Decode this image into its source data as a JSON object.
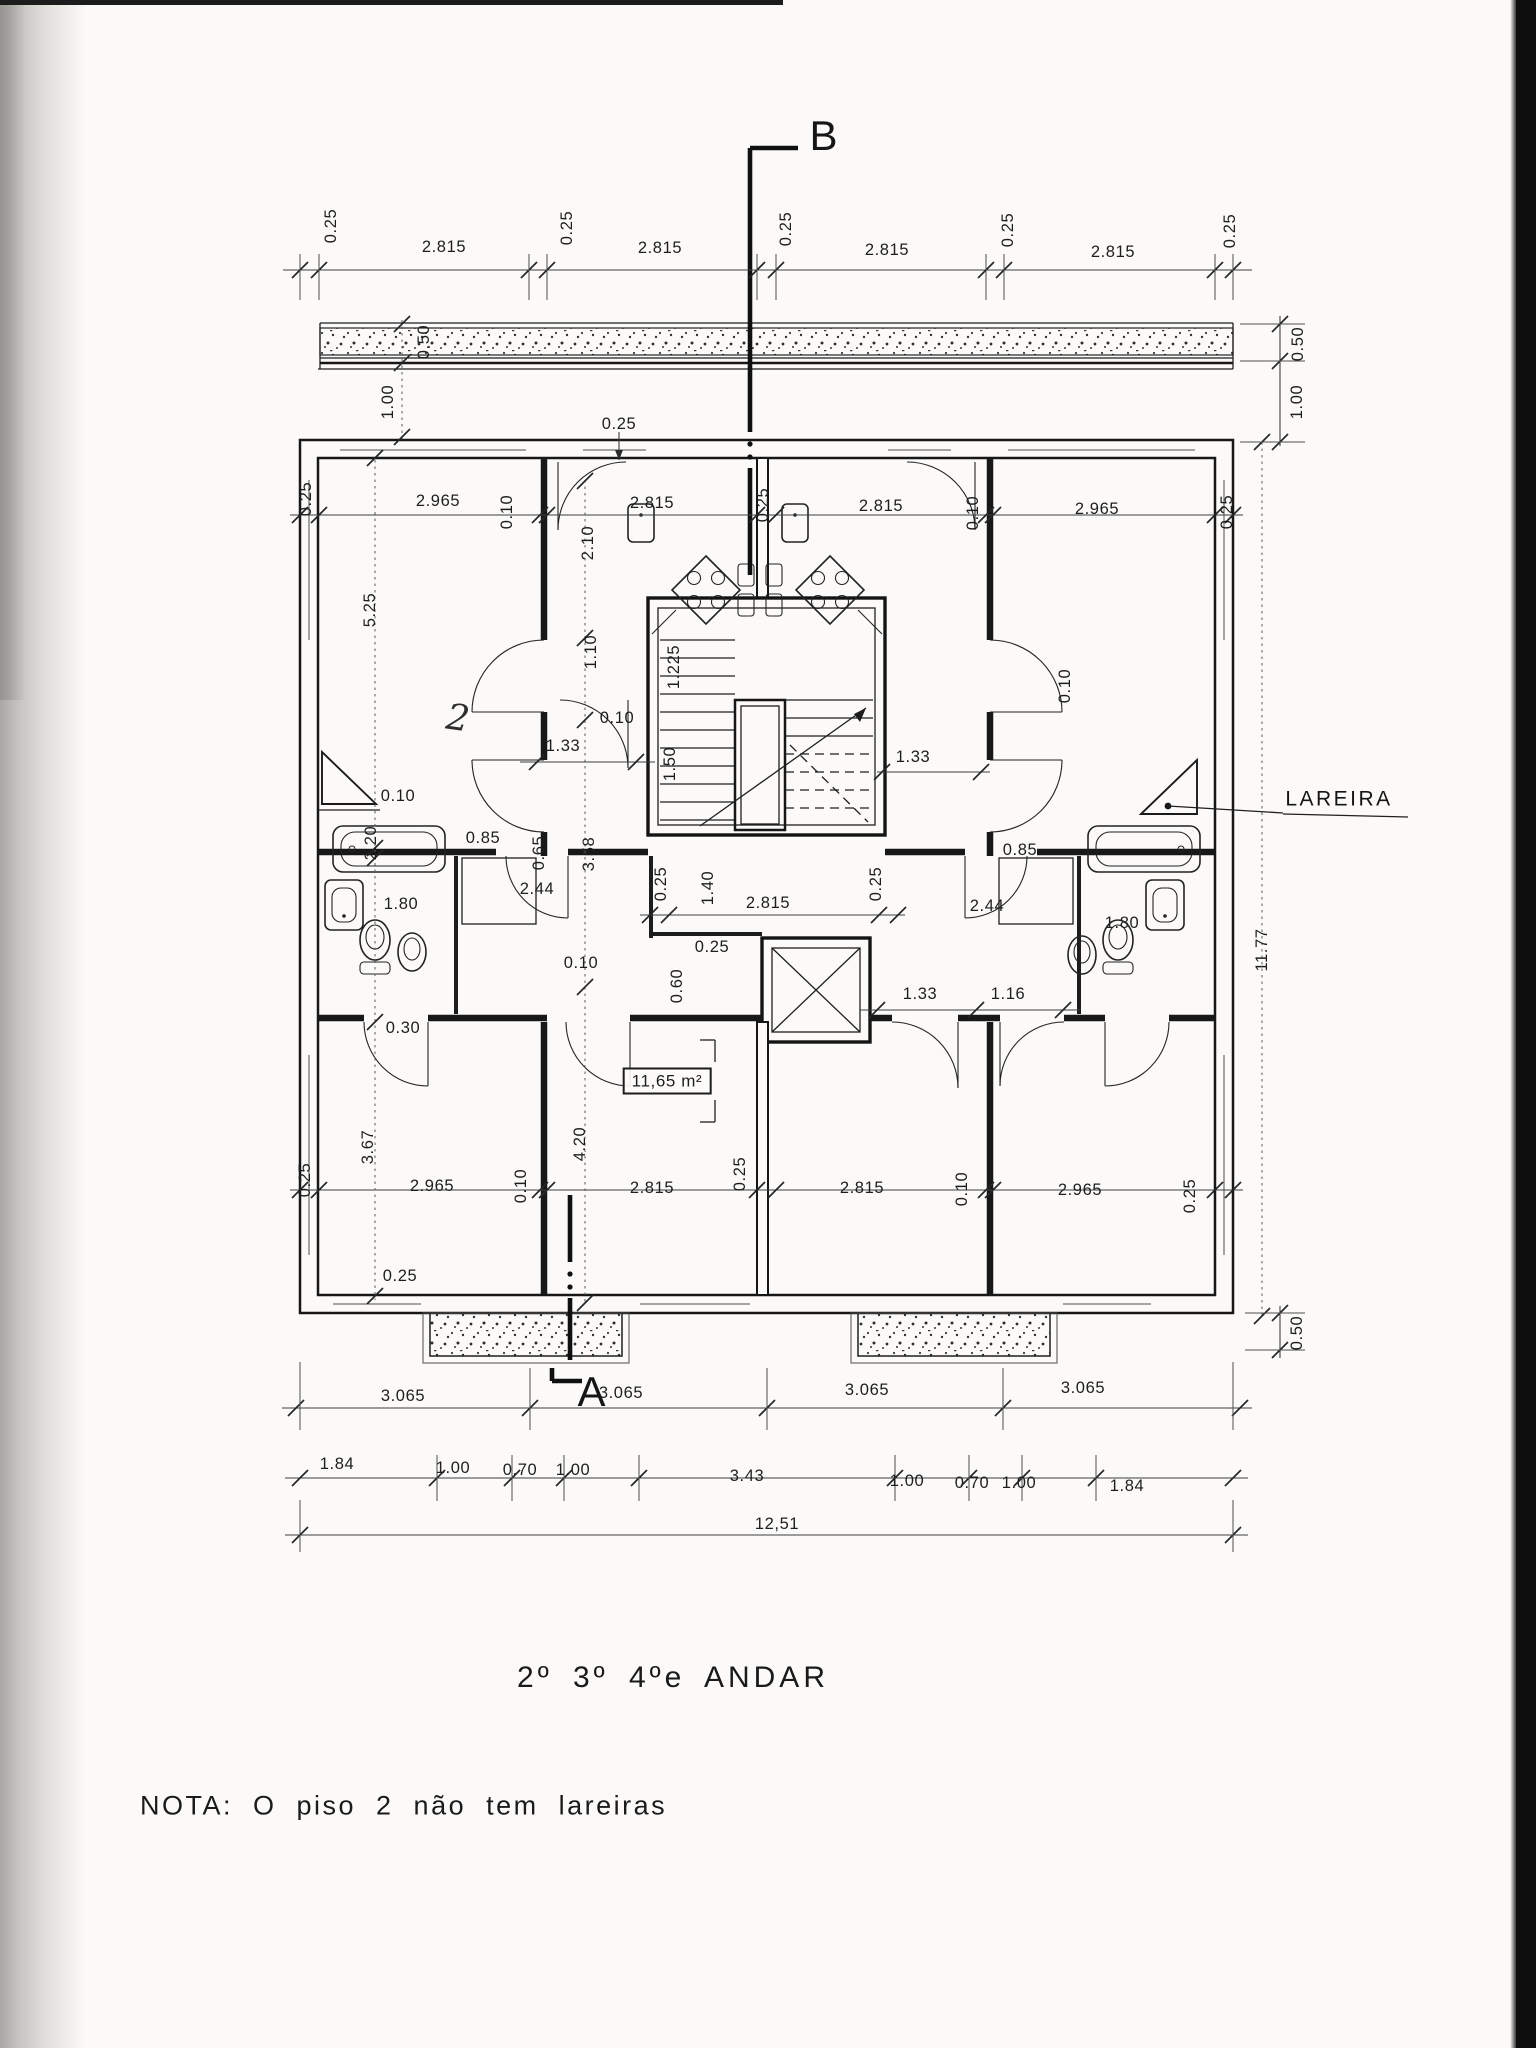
{
  "document": {
    "type_label": "architectural-floor-plan-scan",
    "title": "2º 3º 4ºe ANDAR",
    "note": "NOTA: O  piso 2  não  tem  lareiras",
    "section_marker_top": "B",
    "section_marker_bottom": "A",
    "fireplace_label": "LAREIRA",
    "area_label": "11,65 m²",
    "handwritten_mark": "2",
    "ink_color": "#1a1a1a",
    "paper_color": "#fbfaf8",
    "scan_bar_color": "#0e0e0e"
  },
  "labels": [
    {
      "t": "B",
      "x": 824,
      "y": 136,
      "r": 0,
      "c": "sec",
      "n": "section-marker-b"
    },
    {
      "t": "A",
      "x": 592,
      "y": 1392,
      "r": 0,
      "c": "sec",
      "n": "section-marker-a"
    },
    {
      "t": "0.25",
      "x": 331,
      "y": 226,
      "r": -90
    },
    {
      "t": "2.815",
      "x": 444,
      "y": 247,
      "r": 0
    },
    {
      "t": "0.25",
      "x": 567,
      "y": 228,
      "r": -90
    },
    {
      "t": "2.815",
      "x": 660,
      "y": 248,
      "r": 0
    },
    {
      "t": "0.25",
      "x": 786,
      "y": 229,
      "r": -90
    },
    {
      "t": "2.815",
      "x": 887,
      "y": 250,
      "r": 0
    },
    {
      "t": "0.25",
      "x": 1008,
      "y": 230,
      "r": -90
    },
    {
      "t": "2.815",
      "x": 1113,
      "y": 252,
      "r": 0
    },
    {
      "t": "0.25",
      "x": 1230,
      "y": 231,
      "r": -90
    },
    {
      "t": "0.50",
      "x": 424,
      "y": 342,
      "r": -90
    },
    {
      "t": "1.00",
      "x": 388,
      "y": 402,
      "r": -90
    },
    {
      "t": "0.50",
      "x": 1298,
      "y": 344,
      "r": -90
    },
    {
      "t": "1.00",
      "x": 1297,
      "y": 402,
      "r": -90
    },
    {
      "t": "0.25",
      "x": 619,
      "y": 424,
      "r": 0
    },
    {
      "t": "0.25",
      "x": 306,
      "y": 499,
      "r": -90
    },
    {
      "t": "2.965",
      "x": 438,
      "y": 501,
      "r": 0
    },
    {
      "t": "0.10",
      "x": 507,
      "y": 512,
      "r": -90
    },
    {
      "t": "2.815",
      "x": 652,
      "y": 503,
      "r": 0
    },
    {
      "t": "0.25",
      "x": 763,
      "y": 505,
      "r": -90
    },
    {
      "t": "2.815",
      "x": 881,
      "y": 506,
      "r": 0
    },
    {
      "t": "0.10",
      "x": 973,
      "y": 513,
      "r": -90
    },
    {
      "t": "2.965",
      "x": 1097,
      "y": 509,
      "r": 0
    },
    {
      "t": "0.25",
      "x": 1227,
      "y": 512,
      "r": -90
    },
    {
      "t": "5.25",
      "x": 370,
      "y": 610,
      "r": -90
    },
    {
      "t": "2.10",
      "x": 588,
      "y": 543,
      "r": -90
    },
    {
      "t": "1.10",
      "x": 591,
      "y": 652,
      "r": -90
    },
    {
      "t": "1.225",
      "x": 674,
      "y": 667,
      "r": -90
    },
    {
      "t": "1.33",
      "x": 563,
      "y": 746,
      "r": 0
    },
    {
      "t": "1.50",
      "x": 670,
      "y": 764,
      "r": -90
    },
    {
      "t": "1.33",
      "x": 913,
      "y": 757,
      "r": 0
    },
    {
      "t": "0.10",
      "x": 617,
      "y": 718,
      "r": 0
    },
    {
      "t": "0.85",
      "x": 483,
      "y": 838,
      "r": 0
    },
    {
      "t": "0.65",
      "x": 539,
      "y": 853,
      "r": -90
    },
    {
      "t": "2.44",
      "x": 537,
      "y": 889,
      "r": 0
    },
    {
      "t": "2.20",
      "x": 371,
      "y": 843,
      "r": -90
    },
    {
      "t": "1.80",
      "x": 401,
      "y": 904,
      "r": 0
    },
    {
      "t": "0.10",
      "x": 398,
      "y": 796,
      "r": 0
    },
    {
      "t": "0.30",
      "x": 403,
      "y": 1028,
      "r": 0
    },
    {
      "t": "0.85",
      "x": 1020,
      "y": 850,
      "r": 0
    },
    {
      "t": "0.10",
      "x": 1065,
      "y": 686,
      "r": -90
    },
    {
      "t": "2.44",
      "x": 987,
      "y": 906,
      "r": 0
    },
    {
      "t": "1.80",
      "x": 1122,
      "y": 923,
      "r": 0
    },
    {
      "t": "0.25",
      "x": 661,
      "y": 884,
      "r": -90
    },
    {
      "t": "1.40",
      "x": 708,
      "y": 888,
      "r": -90
    },
    {
      "t": "2.815",
      "x": 768,
      "y": 903,
      "r": 0
    },
    {
      "t": "0.25",
      "x": 876,
      "y": 884,
      "r": -90
    },
    {
      "t": "0.25",
      "x": 712,
      "y": 947,
      "r": 0
    },
    {
      "t": "3.58",
      "x": 589,
      "y": 854,
      "r": -90
    },
    {
      "t": "0.60",
      "x": 677,
      "y": 986,
      "r": -90
    },
    {
      "t": "0.10",
      "x": 581,
      "y": 963,
      "r": 0
    },
    {
      "t": "1.33",
      "x": 920,
      "y": 994,
      "r": 0
    },
    {
      "t": "1.16",
      "x": 1008,
      "y": 994,
      "r": 0
    },
    {
      "t": "11,65 m²",
      "x": 667,
      "y": 1081,
      "r": 0,
      "c": "boxed",
      "n": "area-label"
    },
    {
      "t": "2",
      "x": 458,
      "y": 719,
      "r": 0,
      "c": "hand",
      "n": "handwritten-mark"
    },
    {
      "t": "3.67",
      "x": 368,
      "y": 1147,
      "r": -90
    },
    {
      "t": "4.20",
      "x": 580,
      "y": 1144,
      "r": -90
    },
    {
      "t": "0.25",
      "x": 305,
      "y": 1180,
      "r": -90
    },
    {
      "t": "2.965",
      "x": 432,
      "y": 1186,
      "r": 0
    },
    {
      "t": "0.10",
      "x": 521,
      "y": 1186,
      "r": -90
    },
    {
      "t": "2.815",
      "x": 652,
      "y": 1188,
      "r": 0
    },
    {
      "t": "0.25",
      "x": 740,
      "y": 1174,
      "r": -90
    },
    {
      "t": "2.815",
      "x": 862,
      "y": 1188,
      "r": 0
    },
    {
      "t": "0.10",
      "x": 962,
      "y": 1189,
      "r": -90
    },
    {
      "t": "2.965",
      "x": 1080,
      "y": 1190,
      "r": 0
    },
    {
      "t": "0.25",
      "x": 1190,
      "y": 1196,
      "r": -90
    },
    {
      "t": "0.25",
      "x": 400,
      "y": 1276,
      "r": 0
    },
    {
      "t": "0.50",
      "x": 1297,
      "y": 1333,
      "r": -90
    },
    {
      "t": "11.77",
      "x": 1262,
      "y": 950,
      "r": -90
    },
    {
      "t": "LAREIRA",
      "x": 1339,
      "y": 799,
      "r": 0,
      "c": "lareira",
      "n": "fireplace-label"
    },
    {
      "t": "3.065",
      "x": 403,
      "y": 1396,
      "r": 0
    },
    {
      "t": "3.065",
      "x": 621,
      "y": 1393,
      "r": 0
    },
    {
      "t": "3.065",
      "x": 867,
      "y": 1390,
      "r": 0
    },
    {
      "t": "3.065",
      "x": 1083,
      "y": 1388,
      "r": 0
    },
    {
      "t": "1.84",
      "x": 337,
      "y": 1464,
      "r": 0
    },
    {
      "t": "1.00",
      "x": 453,
      "y": 1468,
      "r": 0
    },
    {
      "t": "0.70",
      "x": 520,
      "y": 1470,
      "r": 0
    },
    {
      "t": "1.00",
      "x": 573,
      "y": 1470,
      "r": 0
    },
    {
      "t": "3.43",
      "x": 747,
      "y": 1476,
      "r": 0
    },
    {
      "t": "1.00",
      "x": 907,
      "y": 1481,
      "r": 0
    },
    {
      "t": "0.70",
      "x": 972,
      "y": 1483,
      "r": 0
    },
    {
      "t": "1.00",
      "x": 1019,
      "y": 1483,
      "r": 0
    },
    {
      "t": "1.84",
      "x": 1127,
      "y": 1486,
      "r": 0
    },
    {
      "t": "12,51",
      "x": 777,
      "y": 1524,
      "r": 0
    },
    {
      "t": "2º 3º 4ºe ANDAR",
      "x": 673,
      "y": 1678,
      "r": 0,
      "c": "title",
      "n": "drawing-title"
    },
    {
      "t": "NOTA: O  piso 2  não  tem  lareiras",
      "x": 140,
      "y": 1806,
      "r": 0,
      "c": "nota",
      "n": "drawing-note"
    }
  ]
}
